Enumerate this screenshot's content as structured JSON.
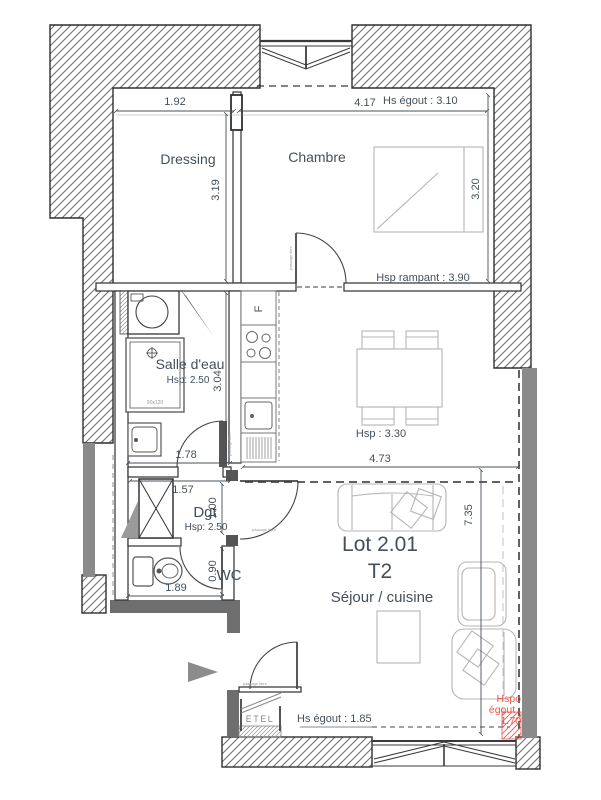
{
  "plan": {
    "rooms": {
      "dressing": "Dressing",
      "chambre": "Chambre",
      "salle_eau": "Salle d'eau",
      "salle_eau_hsp": "Hsp: 2.50",
      "dgt": "Dgt",
      "dgt_hsp": "Hsp: 2.50",
      "wc": "WC",
      "sejour": "Séjour / cuisine",
      "sejour_hsp": "Hsp : 3.30",
      "lot": "Lot 2.01",
      "lot_type": "T2"
    },
    "dims": {
      "w_dressing": "1.92",
      "w_chambre": "4.17",
      "hs_egout_haut": "Hs égout : 3.10",
      "h_dressing": "3.19",
      "h_chambre": "3.20",
      "hsp_rampant": "Hsp rampant : 3.90",
      "h_salle_eau": "3.04",
      "w_salle_eau": "1.78",
      "w_dgt": "1.57",
      "h_dgt": "1.00",
      "h_wc": "0.90",
      "w_wc": "1.89",
      "w_sejour": "4.73",
      "h_sejour": "7.35",
      "hs_egout_bas": "Hs égout : 1.85",
      "hspo_egout_l1": "Hspo",
      "hspo_egout_l2": "égout :",
      "hspo_egout_l3": "1.70"
    },
    "annotations": {
      "etel": "ETEL",
      "fridge": "F",
      "shower_size": "90x120",
      "passage": "passage libre"
    },
    "colors": {
      "text": "#44505a",
      "wall_line": "#2f2f2f",
      "gray_wall": "#8a8a8a",
      "red_accent": "#f0544c",
      "furniture": "#b5b5b5"
    }
  }
}
